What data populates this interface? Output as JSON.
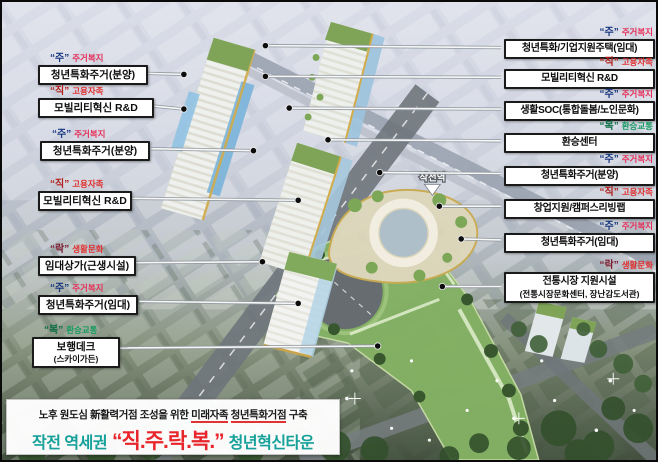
{
  "scene": {
    "station_label": "작전역"
  },
  "legend_colors": {
    "ju_char": "#16357f",
    "jik_char": "#b3201c",
    "rak_char": "#7c1b2e",
    "bok_char": "#0c6e44",
    "housing_label_red": "#e6305a",
    "employment_label_red": "#e02f2f",
    "transit_label_green": "#169a5f",
    "banner_teal": "#15a09a",
    "banner_red": "#e8252b"
  },
  "callouts": {
    "left": [
      {
        "tag_char": "“주”",
        "tag_label": "주거복지",
        "title": "청년특화주거(분양)"
      },
      {
        "tag_char": "“직”",
        "tag_label": "고용자족",
        "title": "모빌리티혁신 R&D"
      },
      {
        "tag_char": "“주”",
        "tag_label": "주거복지",
        "title": "청년특화주거(분양)"
      },
      {
        "tag_char": "“직”",
        "tag_label": "고용자족",
        "title": "모빌리티혁신 R&D"
      },
      {
        "tag_char": "“락”",
        "tag_label": "생활문화",
        "title": "임대상가(근생시설)"
      },
      {
        "tag_char": "“주”",
        "tag_label": "주거복지",
        "title": "청년특화주거(임대)"
      },
      {
        "tag_char": "“복”",
        "tag_label": "환승교통",
        "title": "보행데크",
        "subtitle": "(스카이가든)"
      }
    ],
    "right": [
      {
        "tag_char": "“주”",
        "tag_label": "주거복지",
        "title": "청년특화/기업지원주택(임대)"
      },
      {
        "tag_char": "“직”",
        "tag_label": "고용자족",
        "title": "모빌리티혁신 R&D"
      },
      {
        "tag_char": "“주”",
        "tag_label": "주거복지",
        "title": "생활SOC(통합돌봄/노인문화)"
      },
      {
        "tag_char": "“복”",
        "tag_label": "환승교통",
        "title": "환승센터"
      },
      {
        "tag_char": "“주”",
        "tag_label": "주거복지",
        "title": "청년특화주거(분양)"
      },
      {
        "tag_char": "“직”",
        "tag_label": "고용자족",
        "title": "창업지원/캠퍼스리빙랩"
      },
      {
        "tag_char": "“주”",
        "tag_label": "주거복지",
        "title": "청년특화주거(임대)"
      },
      {
        "tag_char": "“락”",
        "tag_label": "생활문화",
        "title": "전통시장 지원시설",
        "subtitle": "(전통시장문화센터, 장난감도서관)"
      }
    ]
  },
  "banner": {
    "line1": {
      "seg1": "노후 원도심 新활력거점 조성을 위한 ",
      "u1": "미래자족",
      "mid": " ",
      "u2": "청년특화거점",
      "seg2": " 구축"
    },
    "line2": {
      "prefix": "작전 역세권",
      "quote": "“직.주.락.복.”",
      "suffix": "청년혁신타운"
    }
  }
}
